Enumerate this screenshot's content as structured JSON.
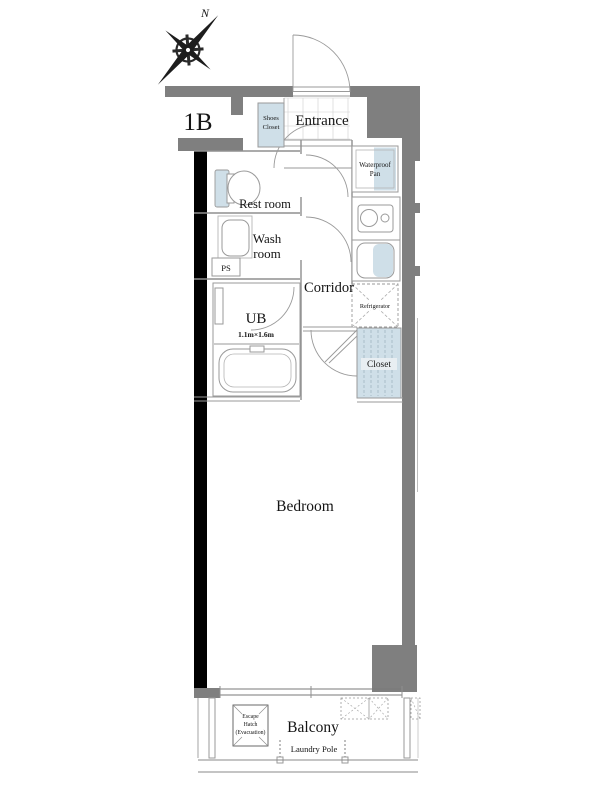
{
  "unit": {
    "type_label": "1B"
  },
  "compass": {
    "north": "N"
  },
  "labels": {
    "entrance": "Entrance",
    "shoes_closet": [
      "Shoes",
      "Closet"
    ],
    "waterproof_pan": [
      "Waterproof",
      "Pan"
    ],
    "rest_room": "Rest room",
    "wash_room": [
      "Wash",
      "room"
    ],
    "ps": "PS",
    "corridor": "Corridor",
    "ub": "UB",
    "ub_size": "1.1m×1.6m",
    "refrigerator": "Refrigerator",
    "closet": "Closet",
    "bedroom": "Bedroom",
    "balcony": "Balcony",
    "escape_hatch": [
      "Escape",
      "Hatch",
      "(Evacuation)"
    ],
    "laundry_pole": "Laundry Pole"
  },
  "colors": {
    "wall_gray": "#7f7f7f",
    "wall_black": "#000000",
    "fixture_blue": "#cfdfe8",
    "outline_gray": "#9a9a9a",
    "text": "#141414",
    "background": "#ffffff"
  }
}
